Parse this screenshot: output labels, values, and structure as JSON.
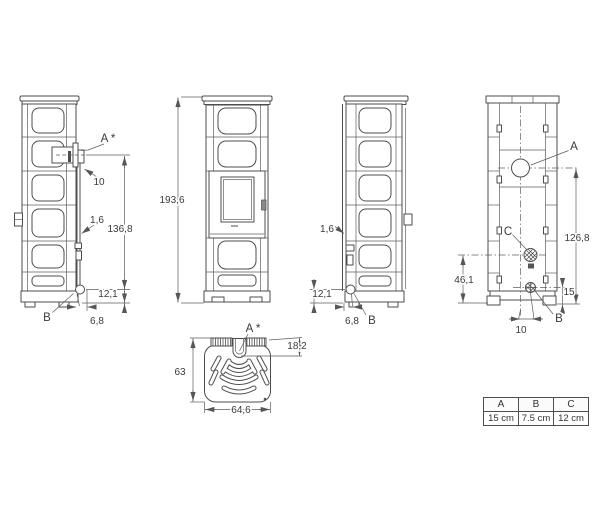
{
  "views": {
    "side_left": {
      "label_a": "A *",
      "dim_pipe_offset": "10",
      "dim_panel_thickness": "1,6",
      "dim_flue_height": "136,8",
      "dim_b_height": "12,1",
      "dim_b_offset": "6,8",
      "label_b": "B"
    },
    "front": {
      "dim_total_height": "193,6"
    },
    "side_right": {
      "dim_panel_thickness": "1,6",
      "dim_b_height": "12,1",
      "dim_b_offset": "6,8",
      "label_b": "B"
    },
    "rear": {
      "label_a": "A",
      "label_c": "C",
      "label_b": "B",
      "dim_flue_height": "126,8",
      "dim_c_height": "46,1",
      "dim_b_height": "15",
      "dim_b_offset": "10"
    },
    "top": {
      "label_a": "A *",
      "dim_flue_depth": "18,2",
      "dim_depth": "63",
      "dim_width": "64,6"
    }
  },
  "legend_table": {
    "headers": [
      "A",
      "B",
      "C"
    ],
    "values": [
      "15 cm",
      "7.5 cm",
      "12 cm"
    ]
  }
}
